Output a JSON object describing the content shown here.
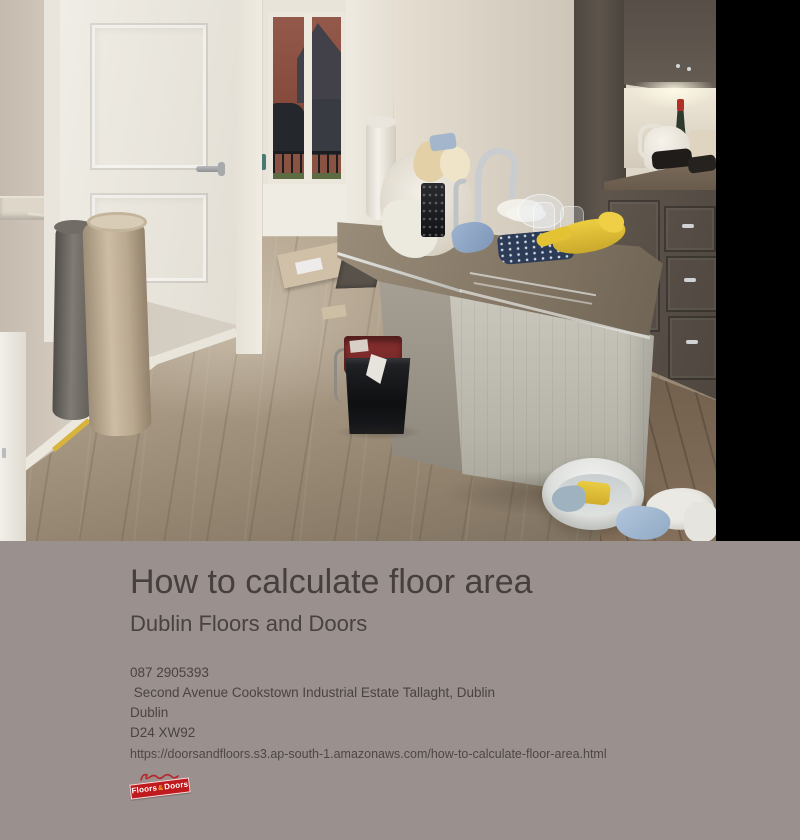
{
  "article": {
    "title": "How to calculate floor area",
    "subtitle": "Dublin Floors and Doors",
    "contact": {
      "phone": "087 2905393",
      "address": " Second Avenue Cookstown Industrial Estate Tallaght, Dublin",
      "city": "Dublin",
      "postcode": "D24 XW92"
    },
    "source_url": "https://doorsandfloors.s3.ap-south-1.amazonaws.com/how-to-calculate-floor-area.html",
    "logo": {
      "banner_left": "Floors",
      "banner_amp": "&",
      "banner_right": "Doors",
      "banner_color": "#bf1a1d"
    }
  },
  "photo": {
    "description": "Kitchen and hallway with newly fitted grey-brown laminate flooring: white panel door, window onto brick houses and parked cars, sage-green kitchen island stacked with dishes, tap, cloths and yellow rubber gloves, dark wood cabinets, rolled underlay and carpet, buckets and a washing-up bowl with sponge on the floor",
    "palette": {
      "wall": "#d5cec2",
      "floor_light": "#c1b29d",
      "floor_dark": "#7b6e5d",
      "island_panel": "#c2c0b6",
      "island_counter": "#8a7d6b",
      "cabinets": "#5a5149",
      "letterbox": "#000000",
      "page_background": "#9a908e"
    }
  }
}
